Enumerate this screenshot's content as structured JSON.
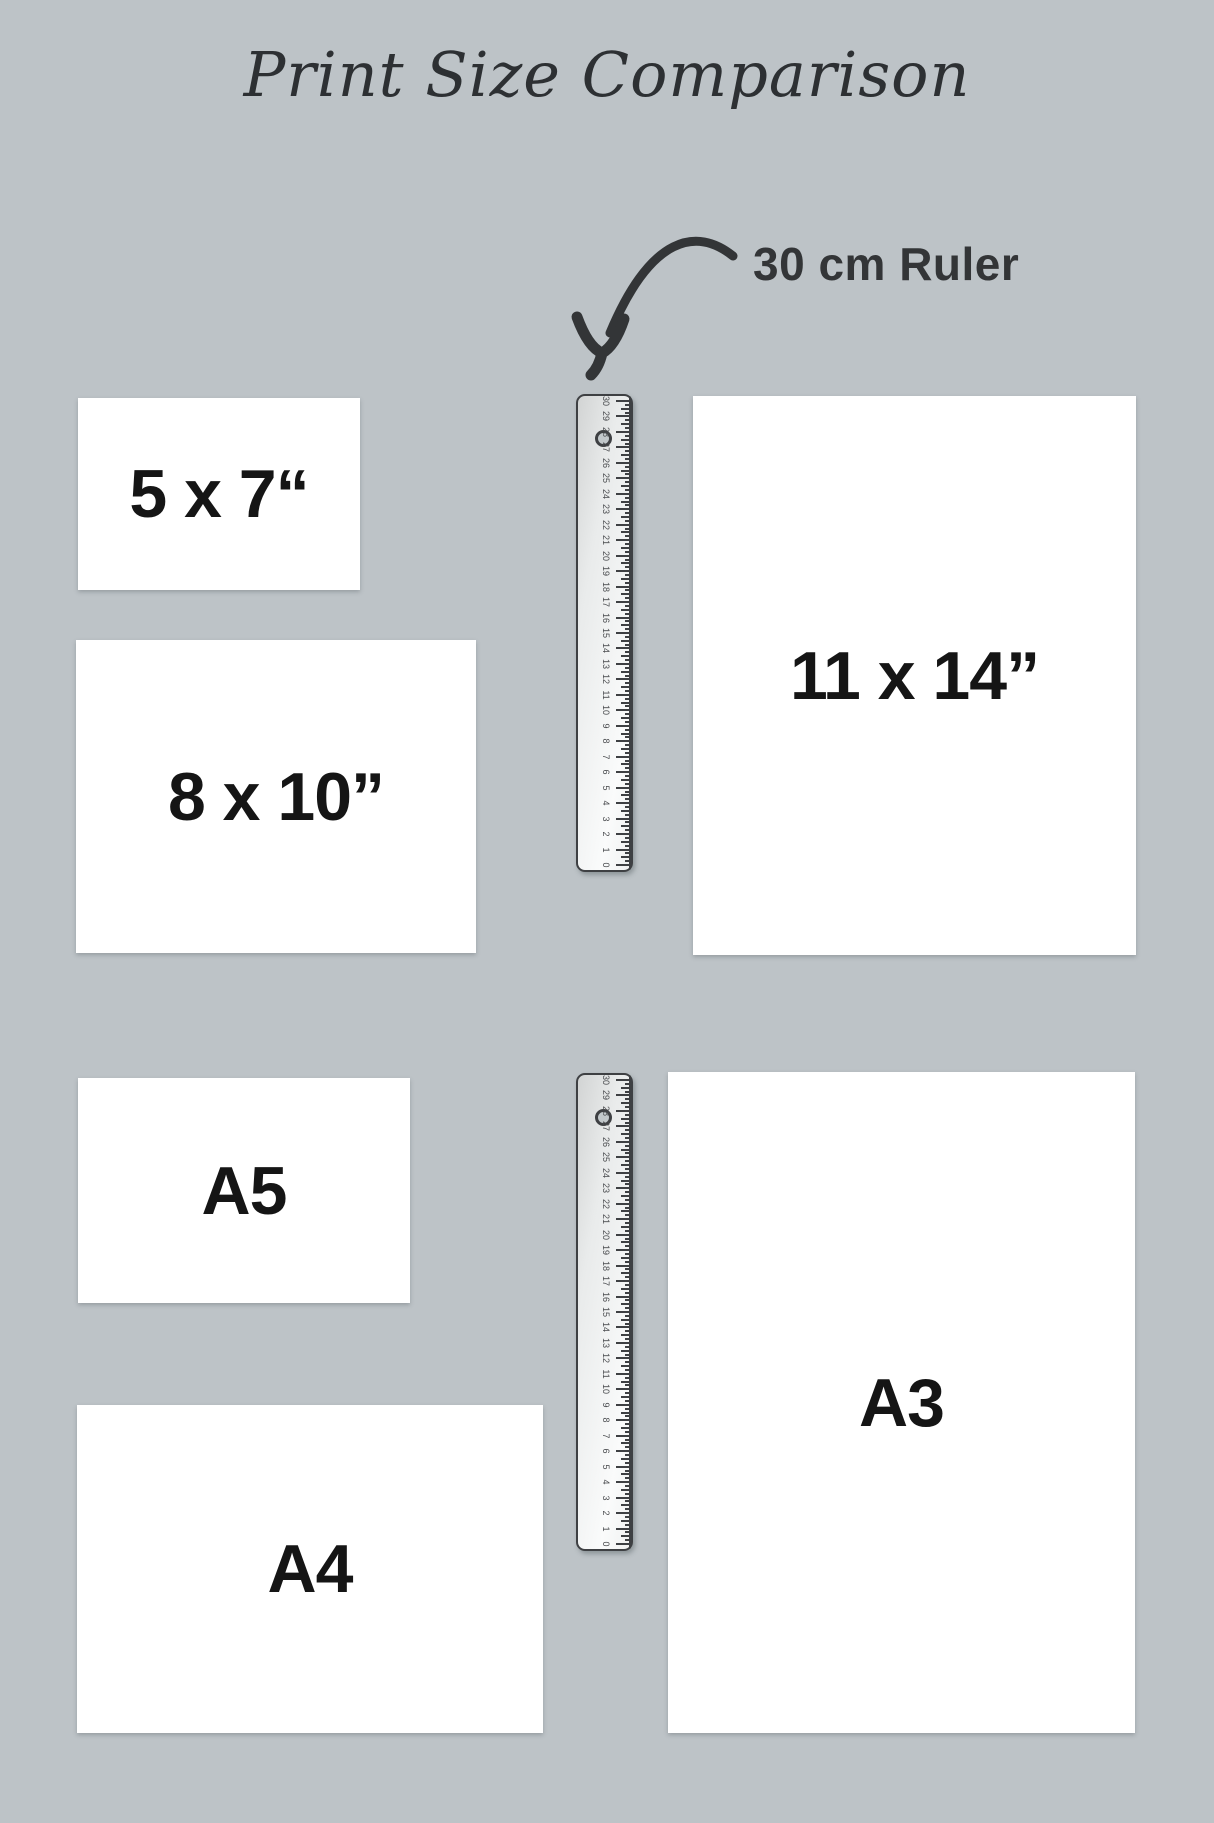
{
  "background_color": "#bdc3c7",
  "ink_color": "#333537",
  "paper_color": "#ffffff",
  "title": "Print Size Comparison",
  "annotation": "30 cm Ruler",
  "papers": [
    {
      "name": "5x7",
      "label": "5 x 7“"
    },
    {
      "name": "8x10",
      "label": "8 x 10”"
    },
    {
      "name": "11x14",
      "label": "11 x 14”"
    },
    {
      "name": "a5",
      "label": "A5"
    },
    {
      "name": "a4",
      "label": "A4"
    },
    {
      "name": "a3",
      "label": "A3"
    }
  ],
  "rulers": {
    "count": 2,
    "unit": "cm",
    "min": 0,
    "max": 30,
    "numbers": [
      "0",
      "1",
      "2",
      "3",
      "4",
      "5",
      "6",
      "7",
      "8",
      "9",
      "10",
      "11",
      "12",
      "13",
      "14",
      "15",
      "16",
      "17",
      "18",
      "19",
      "20",
      "21",
      "22",
      "23",
      "24",
      "25",
      "26",
      "27",
      "28",
      "29",
      "30"
    ]
  }
}
